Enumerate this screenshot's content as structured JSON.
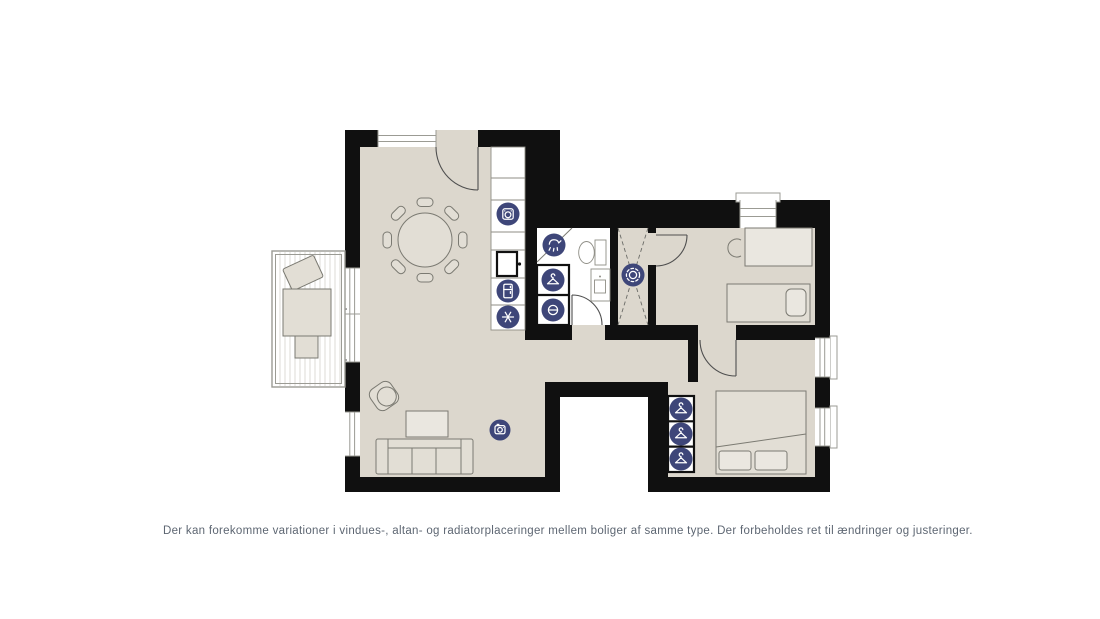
{
  "disclaimer": "Der kan forekomme variationer i vindues-, altan- og radiatorplaceringer mellem boliger af samme type. Der forbeholdes ret til ændringer og justeringer.",
  "colors": {
    "background": "#ffffff",
    "wall": "#101010",
    "floor": "#dcd7cd",
    "white": "#ffffff",
    "furniture_fill": "#e2ded5",
    "outline": "#7b7a72",
    "window": "#9b9b94",
    "icon_bg": "#3e4679",
    "icon_glyph": "#ffffff",
    "text": "#5d6672"
  },
  "floorplan": {
    "type": "2-bedroom apartment floor plan with balcony",
    "rooms": [
      {
        "name": "living-room-kitchen",
        "furniture": [
          "round dining table with 8 chairs",
          "armchair",
          "coffee table",
          "3-seat sofa",
          "kitchen counter with appliances"
        ]
      },
      {
        "name": "balcony",
        "furniture": [
          "lounge chair",
          "table",
          "stool"
        ]
      },
      {
        "name": "bathroom",
        "furniture": [
          "toilet",
          "sink",
          "shower corner",
          "closet with washer"
        ]
      },
      {
        "name": "ventilation-shaft",
        "furniture": []
      },
      {
        "name": "hallway",
        "furniture": []
      },
      {
        "name": "bedroom-1",
        "furniture": [
          "single bed with pillow",
          "desk",
          "chair"
        ]
      },
      {
        "name": "bedroom-2",
        "furniture": [
          "double bed with 2 pillows",
          "3 wardrobe sections"
        ]
      }
    ],
    "icons": [
      {
        "name": "oven-icon",
        "meaning": "oven",
        "location": "kitchen"
      },
      {
        "name": "fridge-icon",
        "meaning": "refrigerator",
        "location": "kitchen"
      },
      {
        "name": "freezer-icon",
        "meaning": "freezer",
        "location": "kitchen"
      },
      {
        "name": "shower-icon",
        "meaning": "shower",
        "location": "bathroom"
      },
      {
        "name": "wardrobe-icon",
        "meaning": "wardrobe / hanger",
        "location": "bathroom closet"
      },
      {
        "name": "washing-machine-icon",
        "meaning": "washing machine",
        "location": "bathroom closet"
      },
      {
        "name": "ventilation-icon",
        "meaning": "ventilation",
        "location": "shaft"
      },
      {
        "name": "camera-icon",
        "meaning": "appliance marker",
        "location": "living room"
      },
      {
        "name": "wardrobe-icon",
        "meaning": "wardrobe / hanger",
        "location": "bedroom 2",
        "count": 3
      }
    ]
  }
}
